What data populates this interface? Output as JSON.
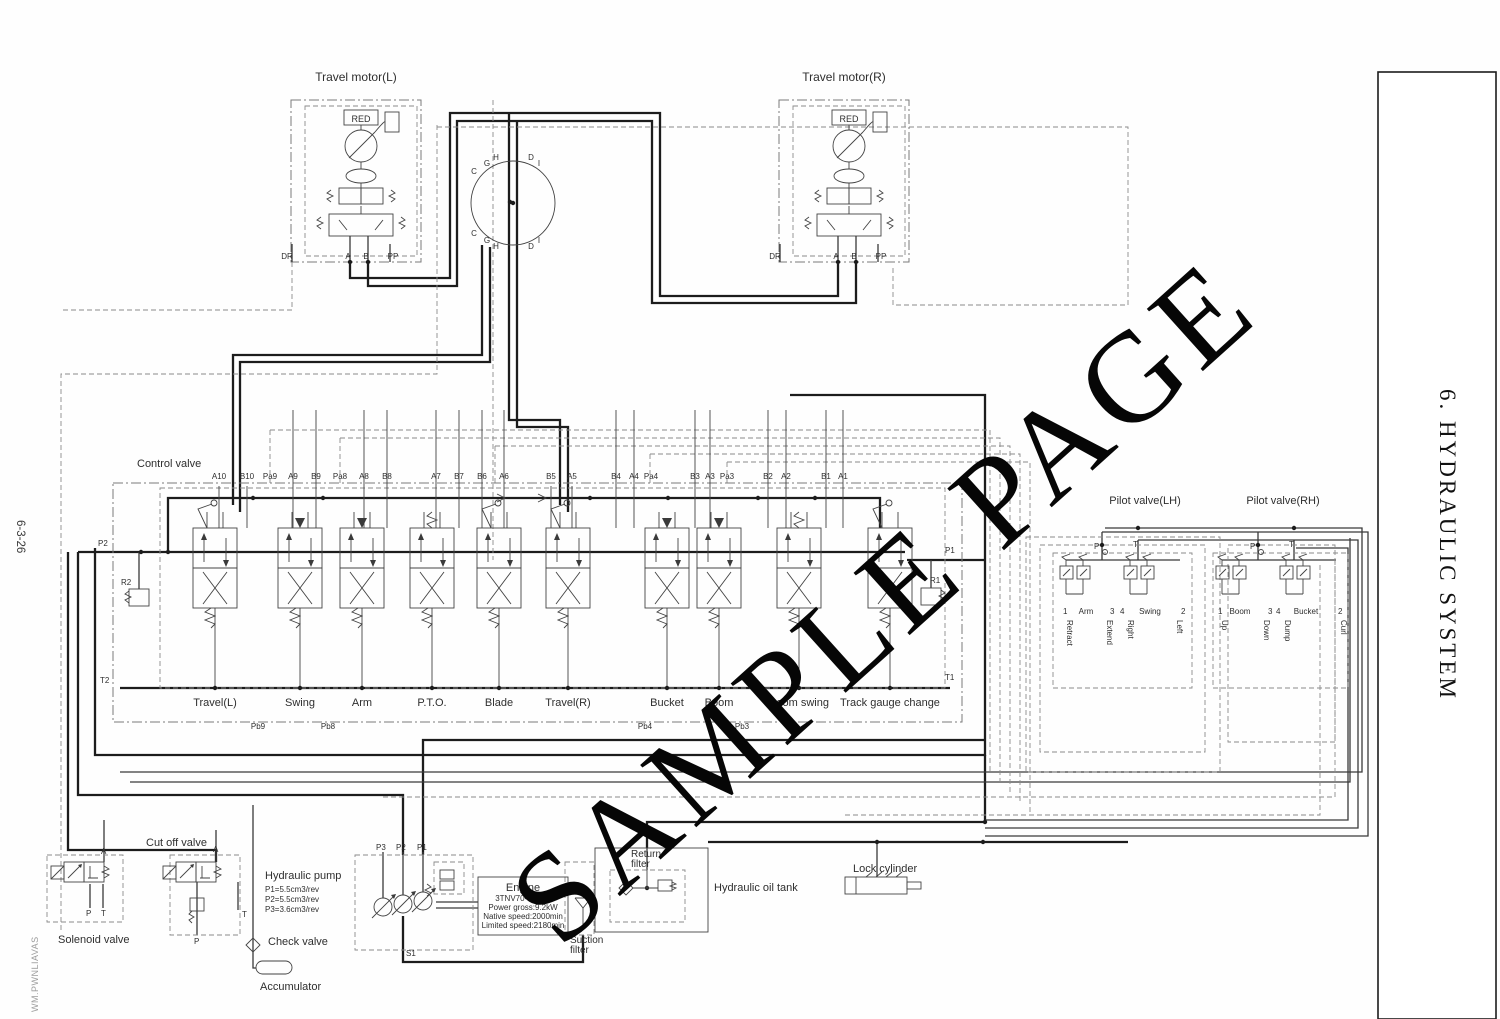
{
  "page": {
    "side_tab": "6. HYDRAULIC SYSTEM",
    "page_number": "6-3-26",
    "watermark": "SAMPLE PAGE",
    "corner_watermark": "WM.PWNLIAVAS"
  },
  "travel_motor_left": {
    "title": "Travel motor(L)",
    "red": "RED",
    "ports": [
      "DR",
      "A",
      "B",
      "PP"
    ]
  },
  "travel_motor_right": {
    "title": "Travel motor(R)",
    "red": "RED",
    "ports": [
      "DR",
      "A",
      "B",
      "PP"
    ]
  },
  "swivel_joint": {
    "top_letters": [
      "C",
      "G",
      "H",
      "D",
      "I"
    ],
    "bottom_letters": [
      "C",
      "G",
      "H",
      "D",
      "I"
    ]
  },
  "control_valve": {
    "title": "Control valve",
    "port_labels": [
      "A10",
      "B10",
      "Pa9",
      "A9",
      "B9",
      "Pa8",
      "A8",
      "B8",
      "A7",
      "B7",
      "B6",
      "A6",
      "B5",
      "A5",
      "B4",
      "A4",
      "Pa4",
      "B3",
      "A3",
      "Pa3",
      "B2",
      "A2",
      "B1",
      "A1"
    ],
    "sections": [
      "Travel(L)",
      "Swing",
      "Arm",
      "P.T.O.",
      "Blade",
      "Travel(R)",
      "Bucket",
      "Boom",
      "Boom swing",
      "Track gauge change"
    ],
    "pb_labels": [
      "Pb9",
      "Pb8",
      "Pb4",
      "Pb3"
    ],
    "p1": "P1",
    "p2": "P2",
    "t1": "T1",
    "t2": "T2",
    "r1": "R1",
    "r2": "R2"
  },
  "pilot_lh": {
    "title": "Pilot valve(LH)",
    "p": "P",
    "t": "T",
    "units": [
      {
        "n1": "1",
        "name": "Arm",
        "n2": "3",
        "l1": "Retract",
        "l2": "Extend"
      },
      {
        "n1": "4",
        "name": "Swing",
        "n2": "2",
        "l1": "Right",
        "l2": "Left"
      }
    ]
  },
  "pilot_rh": {
    "title": "Pilot valve(RH)",
    "p": "P",
    "t": "T",
    "units": [
      {
        "n1": "1",
        "name": "Boom",
        "n2": "3",
        "l1": "Up",
        "l2": "Down"
      },
      {
        "n1": "4",
        "name": "Bucket",
        "n2": "2",
        "l1": "Dump",
        "l2": "Curl"
      }
    ]
  },
  "bottom": {
    "solenoid_valve": {
      "label": "Solenoid valve",
      "a": "A",
      "p": "P",
      "t": "T"
    },
    "cut_off_valve": {
      "label": "Cut off valve",
      "a": "A",
      "p": "P",
      "t": "T"
    },
    "pump": {
      "label": "Hydraulic pump",
      "specs": [
        "P1=5.5cm3/rev",
        "P2=5.5cm3/rev",
        "P3=3.6cm3/rev"
      ],
      "ports": [
        "P3",
        "P2",
        "P1"
      ],
      "s1": "S1"
    },
    "check_valve": "Check valve",
    "accumulator": "Accumulator",
    "engine": {
      "title": "Engine",
      "model": "3TNV70-WBVB",
      "power": "Power gross:9.2kW",
      "speed": "Native speed:2000min",
      "limit": "Limited speed:2180min"
    },
    "suction_filter": {
      "l1": "Suction",
      "l2": "filter"
    },
    "return_filter": {
      "l1": "Return",
      "l2": "filter"
    },
    "tank": "Hydraulic oil tank",
    "lock_cylinder": "Lock cylinder"
  }
}
